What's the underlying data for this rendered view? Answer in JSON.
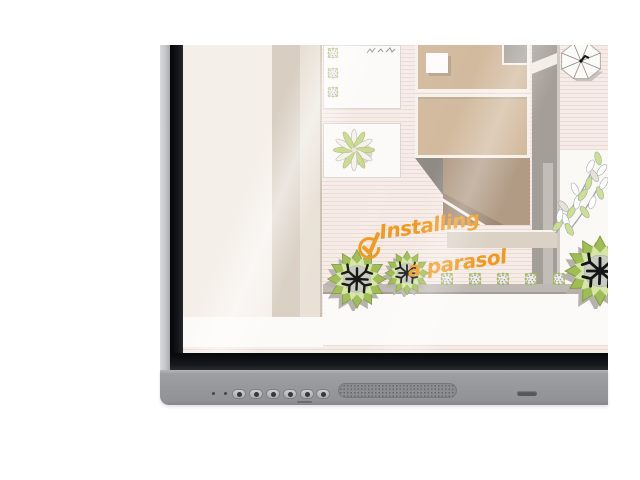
{
  "canvas": {
    "background": "#ffffff"
  },
  "screen_annotation": {
    "check_icon": "✓",
    "line1": "Installing",
    "line2": "a parasol",
    "ink_color": "#F0991E"
  },
  "device": {
    "type": "interactive flat panel (bottom-left corner shown)",
    "frame_color": "#97999C",
    "bezel_color": "#131417",
    "mic_dots": 2,
    "button_count": 6,
    "buttons": [
      {
        "id": "panel-button-1"
      },
      {
        "id": "panel-button-2"
      },
      {
        "id": "panel-button-3"
      },
      {
        "id": "panel-button-4"
      },
      {
        "id": "panel-button-5"
      },
      {
        "id": "panel-button-6"
      }
    ],
    "speaker": "speaker-grille",
    "sensor": "status-slot"
  },
  "plan": {
    "kind": "top-down garden and terrace plan",
    "colors": {
      "paper": "#F6ECE7",
      "stripe": "#ECDAD3",
      "wall_beige": "#D8CEC1",
      "room_tan": "#D2BA9E",
      "room_taupe": "#B19B85",
      "wall_gray": "#A49E98",
      "leaf_lime": "#9FBD55",
      "leaf_light": "#D7E5A9"
    },
    "elements": [
      "patio",
      "garden-wall",
      "planter-bed",
      "agave-plant",
      "house-rooms",
      "table",
      "terrace-edge",
      "parasol",
      "hedge-planter-row",
      "round-trees",
      "leaf-shrub"
    ]
  }
}
